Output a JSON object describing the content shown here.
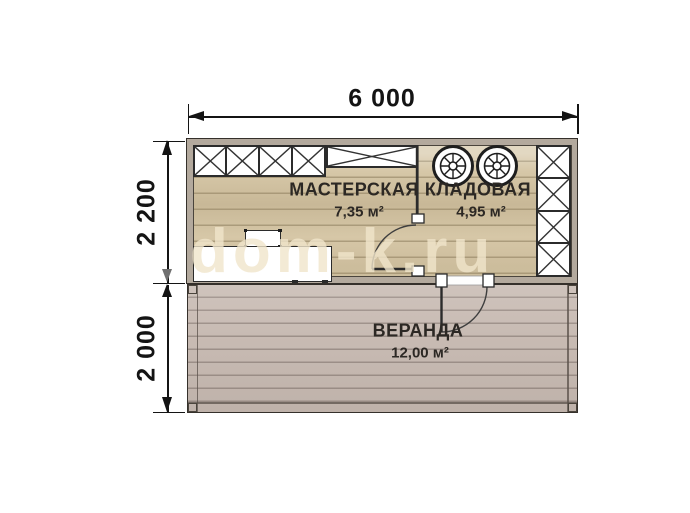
{
  "watermark": "dom-k.ru",
  "dimensions": {
    "total_width": "6 000",
    "upper_height": "2 200",
    "lower_height": "2 000"
  },
  "rooms": {
    "workshop": {
      "name": "МАСТЕРСКАЯ",
      "area": "7,35 м²"
    },
    "storage": {
      "name": "КЛАДОВАЯ",
      "area": "4,95 м²"
    },
    "veranda": {
      "name": "ВЕРАНДА",
      "area": "12,00 м²"
    }
  },
  "colors": {
    "wood_floor": "#d6c7a7",
    "wood_floor_line": "#ac9d7d",
    "veranda_floor": "#c8bbb3",
    "veranda_floor_line": "#9d9089",
    "wall_fill": "#b3a99d",
    "outline": "#35302b",
    "dimension_ink": "#141414",
    "watermark_ink": "rgba(240,229,203,0.8)"
  }
}
